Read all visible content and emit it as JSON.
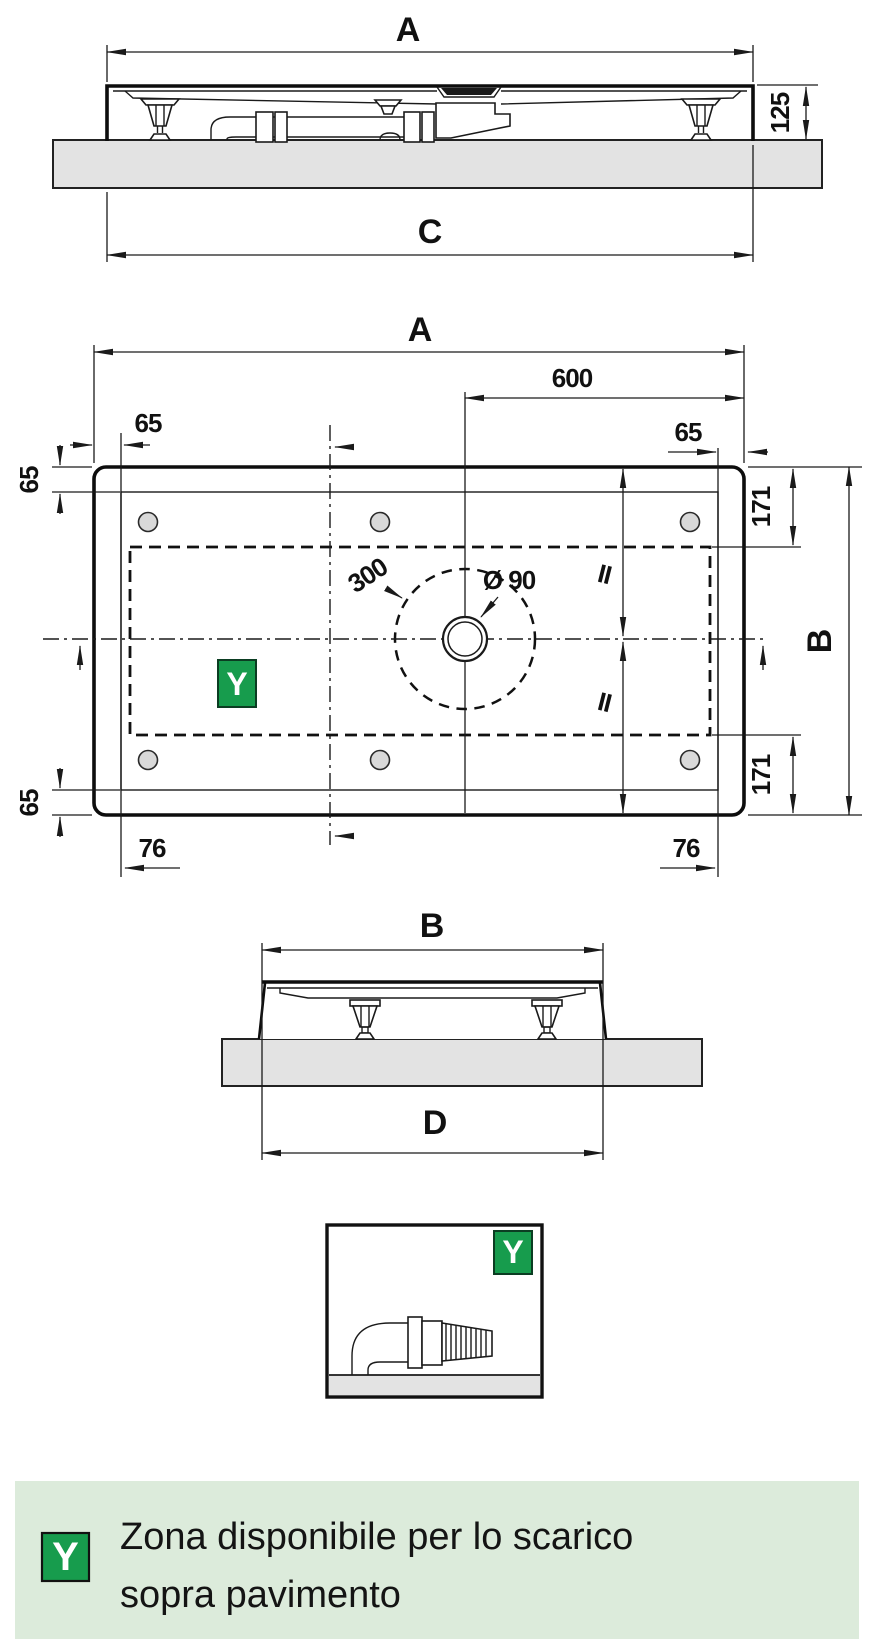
{
  "labels": {
    "front": {
      "width": "A",
      "base": "C",
      "height": "125"
    },
    "plan": {
      "width": "A",
      "drain_offset": "600",
      "rim_top_left": "65",
      "rim_top_right": "65",
      "rim_left_upper": "65",
      "rim_left_lower": "65",
      "corner_top_right": "171",
      "corner_bottom_right": "171",
      "depth": "B",
      "foot_left": "76",
      "foot_right": "76",
      "clearance": "300",
      "drain_dia": "Ø 90",
      "equal_top": "II",
      "equal_bottom": "II",
      "zone": "Y"
    },
    "side": {
      "width": "B",
      "base": "D"
    },
    "detail": {
      "zone": "Y"
    },
    "legend": {
      "badge": "Y",
      "line1": "Zona disponibile per lo scarico",
      "line2": "sopra pavimento"
    }
  },
  "colors": {
    "zone_fill": "#b8ddc6",
    "badge_green": "#179c4d",
    "legend_band": "#dcebdb",
    "floor_gray": "#e3e3e3",
    "line": "#1a1a1a"
  }
}
